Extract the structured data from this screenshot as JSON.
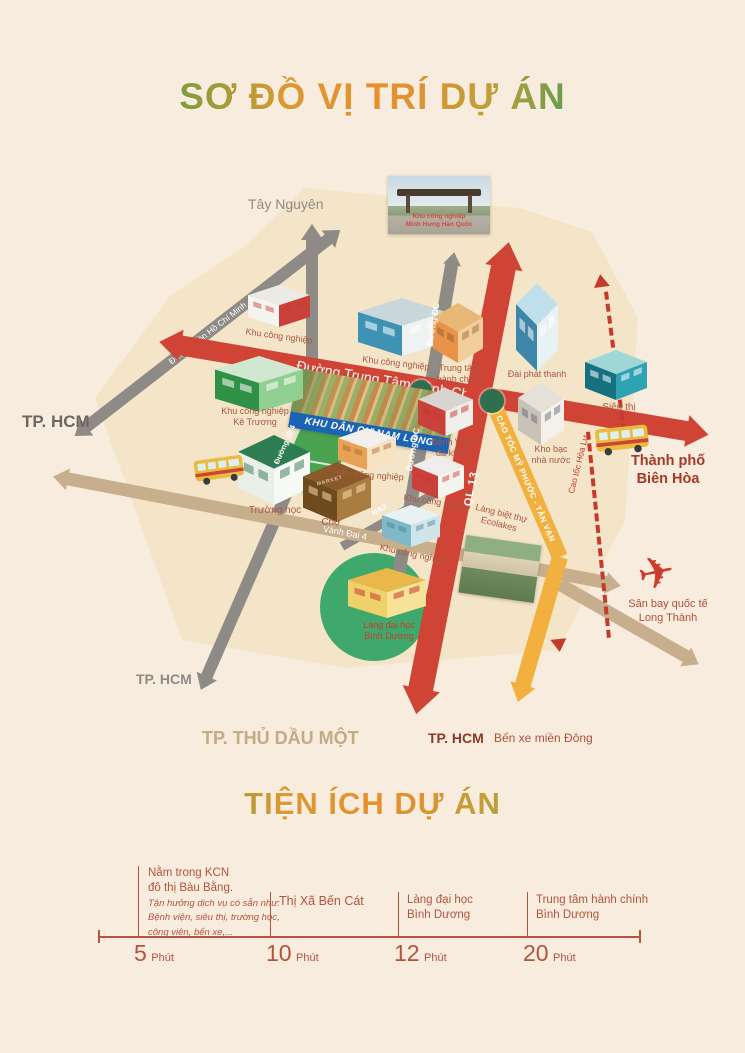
{
  "title": "SƠ ĐỒ VỊ TRÍ DỰ ÁN",
  "colors": {
    "background": "#f7ecdd",
    "map_fill": "#f4e4c8",
    "road_red": "#cf4435",
    "road_yellow": "#f2b13e",
    "road_gray": "#8e8b86",
    "road_tan": "#c7ae8c",
    "dashed_red": "#c43b2e",
    "banner_blue": "#1a63b5",
    "roundabout_green": "#2e6f50",
    "university_green": "#3fa86d",
    "timeline_accent": "#b2543f"
  },
  "map": {
    "destinations": {
      "tay_nguyen": "Tây Nguyên",
      "tphcm_west": "TP. HCM",
      "tphcm_southwest": "TP. HCM",
      "thu_dau_mot": "TP. THỦ DẦU MỘT",
      "tphcm_south": "TP. HCM",
      "ben_xe_mien_dong": "Bến xe miền Đông",
      "bien_hoa": "Thành phố\nBiên Hòa",
      "airport": "Sân bay quốc tế\nLong Thành"
    },
    "roads": {
      "ho_chi_minh_trail": "Đường mòn Hồ Chí Minh",
      "trung_tam_hanh_chinh": "Đường Trung Tâm Hành Chính",
      "ql13": "QL 13",
      "cao_toc_my_phuoc_tan_van": "CAO TỐC MỸ PHƯỚC - TÂN VẠN",
      "cao_toc_hoa_lu": "Cao tốc Hòa Lư",
      "duong_dc": "Đường ĐC",
      "duong_304": "Đường 30/4",
      "na3": "NA3",
      "vanh_dai_4": "Vành Đai 4"
    },
    "places": {
      "kcn_minh_hung": "Khu công nghiệp\nMinh Hưng Hàn Quốc",
      "kcn_1": "Khu công nghiệp",
      "kcn_2": "Khu công nghiệp",
      "kcn_ke_truong": "Khu công nghiệp\nKê Trương",
      "trung_tam_hanh_chinh": "Trung tâm\nhành chính",
      "dai_phat_thanh": "Đài phát thanh",
      "sieu_thi": "Siêu thị",
      "kho_bac": "Kho bạc\nnhà nước",
      "benh_vien": "Bệnh Viện\nđa khoa",
      "truong_hoc": "Trường học",
      "cho": "Chợ",
      "market_sign": "MARKET",
      "kcn_3": "Khu công nghiệp",
      "kcn_4": "Khu công nghiệp",
      "kcn_5": "Khu công nghiệp",
      "nam_long": "KHU DÂN CƯ NAM LONG",
      "ecolakes": "Làng biệt thự\nEcolakes",
      "dai_hoc_binh_duong": "Làng đại học\nBình Dương"
    }
  },
  "amenities": {
    "title": "TIỆN ÍCH DỰ ÁN",
    "items": [
      {
        "heading": "Nằm trong KCN\nđô thị Bàu Bằng.",
        "detail": "Tận hưởng dịch vụ có sẵn như:\nBệnh viện, siêu thị, trường học,\ncông viên, bến xe,...",
        "time": "5",
        "unit": "Phút"
      },
      {
        "heading": "Thị Xã Bến Cát",
        "detail": "",
        "time": "10",
        "unit": "Phút"
      },
      {
        "heading": "Làng đại học\nBình Dương",
        "detail": "",
        "time": "12",
        "unit": "Phút"
      },
      {
        "heading": "Trung tâm hành chính\nBình Dương",
        "detail": "",
        "time": "20",
        "unit": "Phút"
      }
    ]
  }
}
